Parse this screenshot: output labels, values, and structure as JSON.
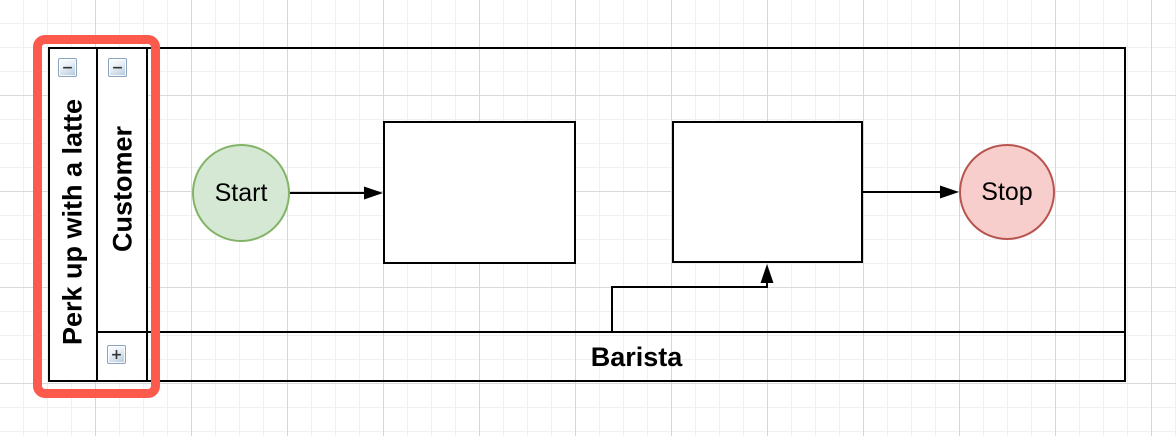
{
  "pool": {
    "title": "Perk up with a latte",
    "collapse_glyph": "−"
  },
  "lanes": [
    {
      "title": "Customer",
      "collapsed": false,
      "collapse_glyph": "−"
    },
    {
      "title": "Barista",
      "collapsed": true,
      "collapse_glyph": "+"
    }
  ],
  "nodes": [
    {
      "label": "Start",
      "shape": "ellipse",
      "fill": "#d5e8d4",
      "stroke": "#82b366"
    },
    {
      "label": "",
      "shape": "rectangle",
      "fill": "#ffffff",
      "stroke": "#000000"
    },
    {
      "label": "",
      "shape": "rectangle",
      "fill": "#ffffff",
      "stroke": "#000000"
    },
    {
      "label": "Stop",
      "shape": "ellipse",
      "fill": "#f8cecc",
      "stroke": "#b85450"
    }
  ],
  "connectors": [
    {
      "from": "start-node",
      "to": "task-1"
    },
    {
      "from": "barista-lane",
      "to": "task-2"
    },
    {
      "from": "task-2",
      "to": "stop-node"
    }
  ],
  "annotation": {
    "type": "selection-highlight",
    "color": "#fb5a4c",
    "target": "pool-and-lane-titles"
  }
}
